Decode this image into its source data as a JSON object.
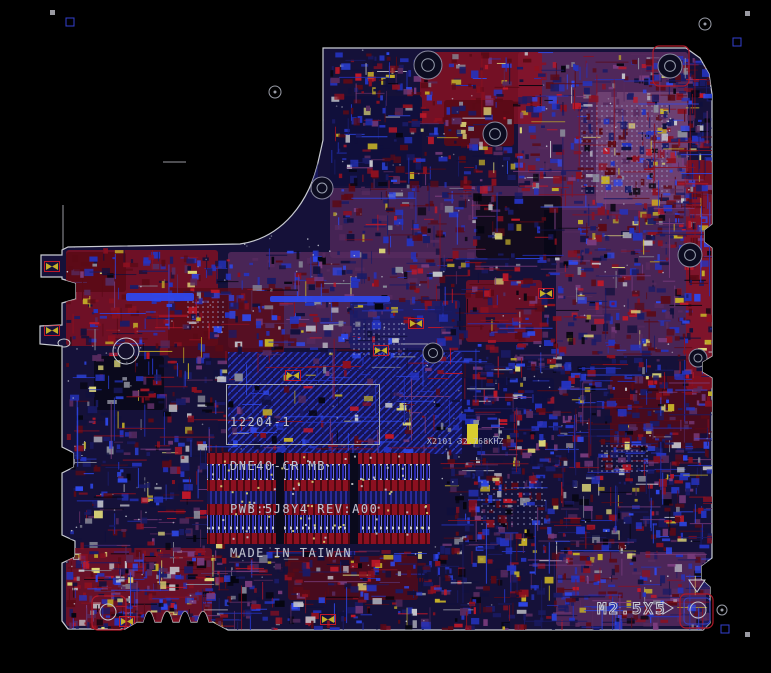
{
  "window": {
    "background": "#000000"
  },
  "board": {
    "silkscreen_label": {
      "lines": [
        "12204-1",
        "DNE40-CR MB",
        "PWB:5J8Y4 REV:A00",
        "MADE IN TAIWAN"
      ]
    },
    "crystal_label": "X2101 32.768KHZ",
    "screw_label": "M2.5X5",
    "colors": {
      "outline": "#c9ccd2",
      "base": "#151139",
      "red": "#8c1020",
      "dark_red": "#5a0a16",
      "bright_red": "#c01828",
      "blue": "#2433c0",
      "bright_blue": "#2e48ec",
      "dark_blue": "#1a1b66",
      "navy": "#10103c",
      "purple": "#562a5e",
      "bright_purple": "#7a3c7e",
      "mauve": "#8a5a88",
      "yellow": "#c4b028",
      "pale_yellow": "#ded878",
      "silk": "#c4c6cc",
      "gray": "#8a8c9a",
      "black": "#05050f"
    }
  }
}
